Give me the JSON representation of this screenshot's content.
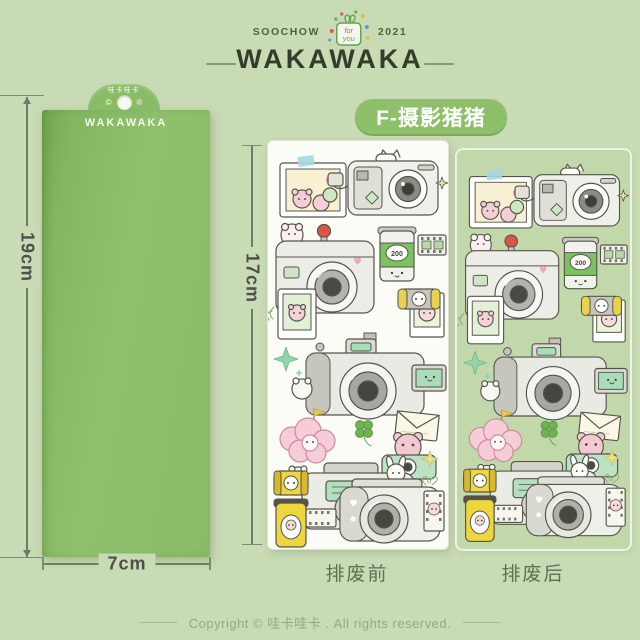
{
  "colors": {
    "page_bg": "#c9dbb5",
    "backing_sheet_green": "#8abb66",
    "pill_green": "#8ec06c",
    "white_sheet": "#fcfcf6",
    "after_sheet_green": "#c2d8ab",
    "dimension_text": "#4e4e4a",
    "brand_title_text": "#333d2b",
    "caption_text": "#5e6f55",
    "footer_text": "#96a689",
    "film_green": "#7cc261",
    "film_yellow": "#eed63f",
    "accent_red": "#dd5447"
  },
  "header": {
    "soochow": "SOOCHOW",
    "year": "2021",
    "gift_line1": "for",
    "gift_line2": "you",
    "brand": "WAKAWAKA"
  },
  "product_pill": {
    "label": "F-摄影猪猪"
  },
  "backing_sheet": {
    "tab_text_cn": "哇卡哇卡",
    "copyright_mark": "©",
    "registered_mark": "®",
    "brand": "WAKAWAKA"
  },
  "measurements": {
    "backing_height": "19cm",
    "backing_width": "7cm",
    "sticker_sheet_height": "17cm"
  },
  "sticker_sheets": {
    "before": {
      "caption": "排废前"
    },
    "after": {
      "caption": "排废后"
    },
    "film_speed_label": "200",
    "icons": [
      "photo-frame-sticker",
      "instax-camera-sticker",
      "dslr-red-shutter-sticker",
      "film-roll-green-sticker",
      "film-negative-sticker",
      "mini-photo-sticker",
      "framed-photo-sticker",
      "battery-sticker",
      "sparkle-icon",
      "dslr-flip-screen-sticker",
      "pink-poodle-sticker",
      "envelope-sticker",
      "clover-icon",
      "frog-camera-sticker",
      "compact-camera-sticker",
      "yellow-film-canister-sticker",
      "yellow-film-roll-sticker",
      "camera-bunny-sticker"
    ]
  },
  "footer": {
    "copyright": "Copyright © 哇卡哇卡 . All rights reserved."
  }
}
